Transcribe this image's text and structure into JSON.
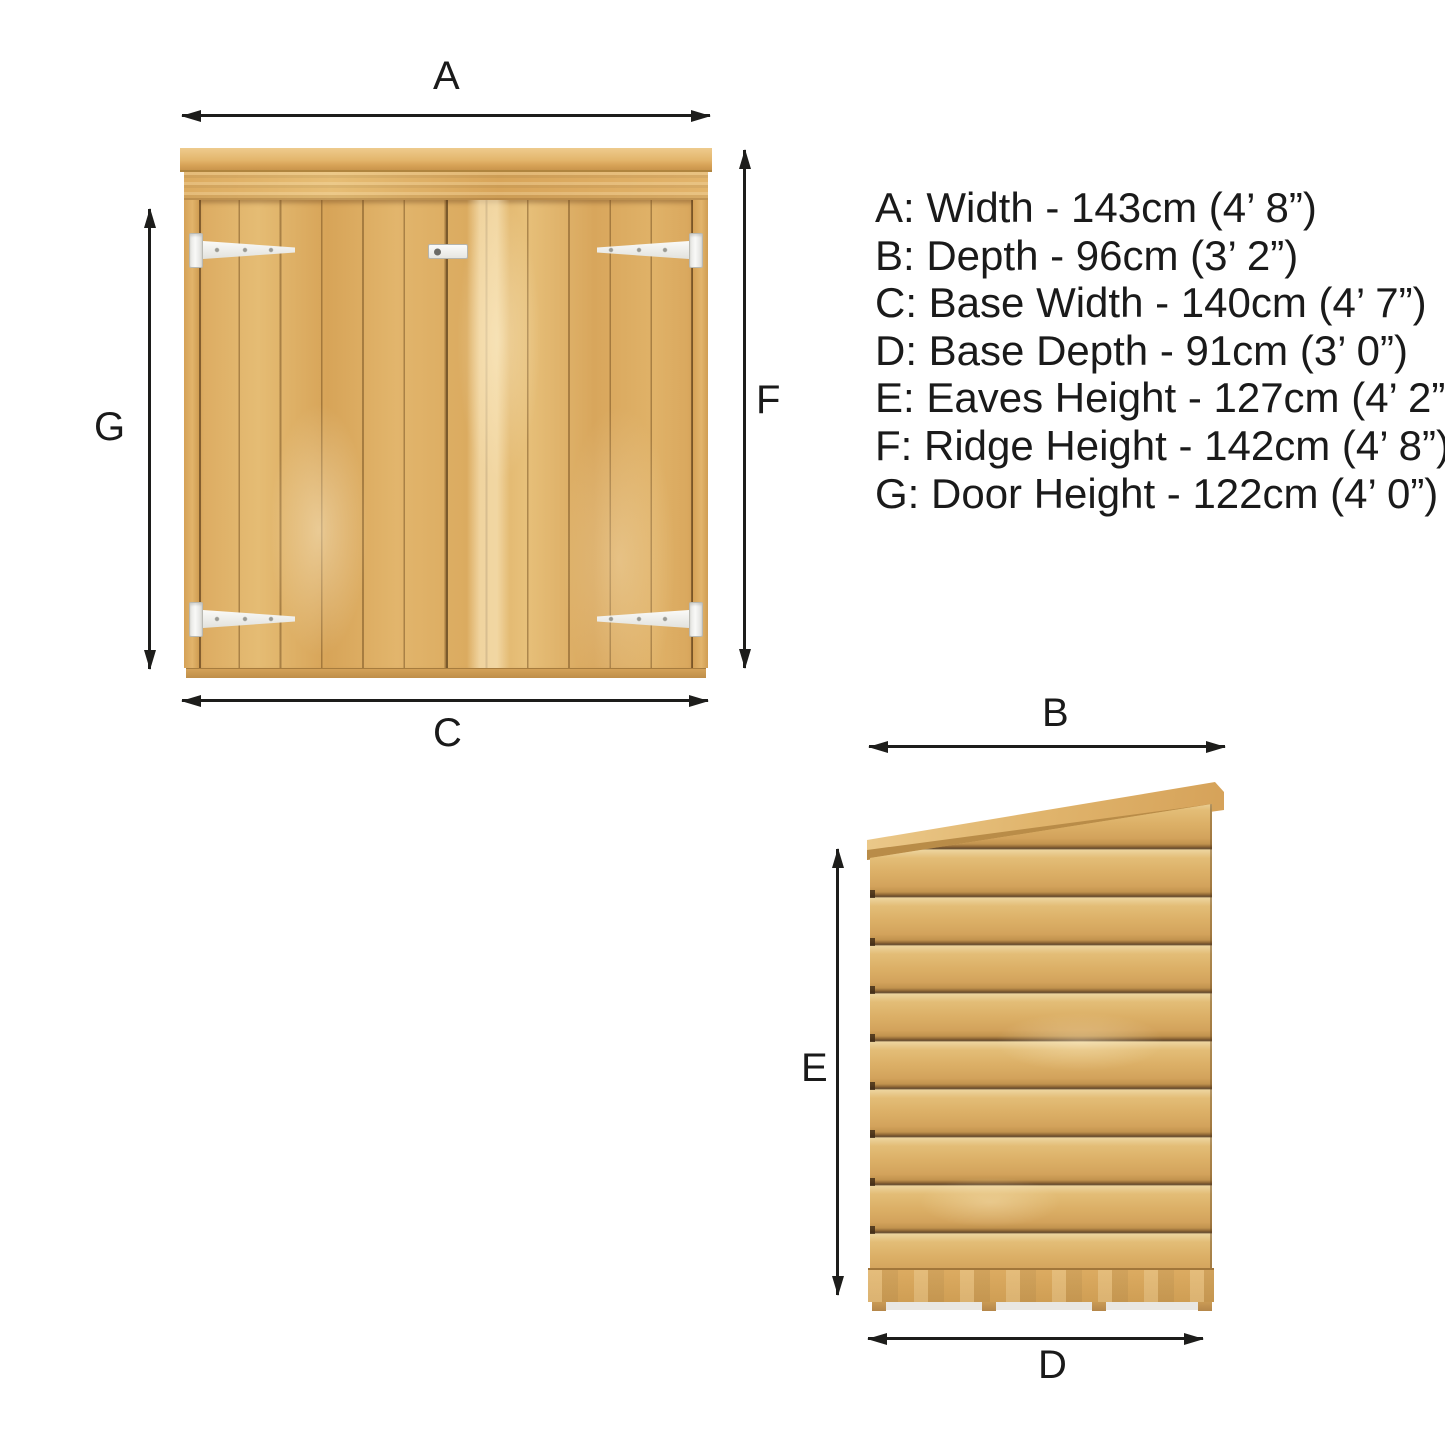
{
  "colors": {
    "background": "#ffffff",
    "text": "#1a1a1a",
    "arrow": "#1d1d1b",
    "wood_light": "#eccf96",
    "wood_mid": "#ddae65",
    "wood_dark": "#b98a44",
    "plank_gap_shadow": "#5f452a",
    "hinge_white": "#f4f4f1"
  },
  "legend": {
    "items": [
      {
        "text": "A: Width - 143cm (4’ 8”)"
      },
      {
        "text": "B: Depth - 96cm (3’ 2”)"
      },
      {
        "text": "C: Base Width - 140cm (4’ 7”)"
      },
      {
        "text": "D: Base Depth - 91cm (3’ 0”)"
      },
      {
        "text": "E: Eaves Height - 127cm (4’ 2”)"
      },
      {
        "text": "F: Ridge Height - 142cm (4’ 8”)"
      },
      {
        "text": "G: Door Height - 122cm (4’ 0”)"
      }
    ]
  },
  "front_view": {
    "width_letter": "A",
    "door_height_letter": "G",
    "ridge_height_letter": "F",
    "base_width_letter": "C"
  },
  "side_view": {
    "depth_letter": "B",
    "eaves_height_letter": "E",
    "base_depth_letter": "D"
  }
}
